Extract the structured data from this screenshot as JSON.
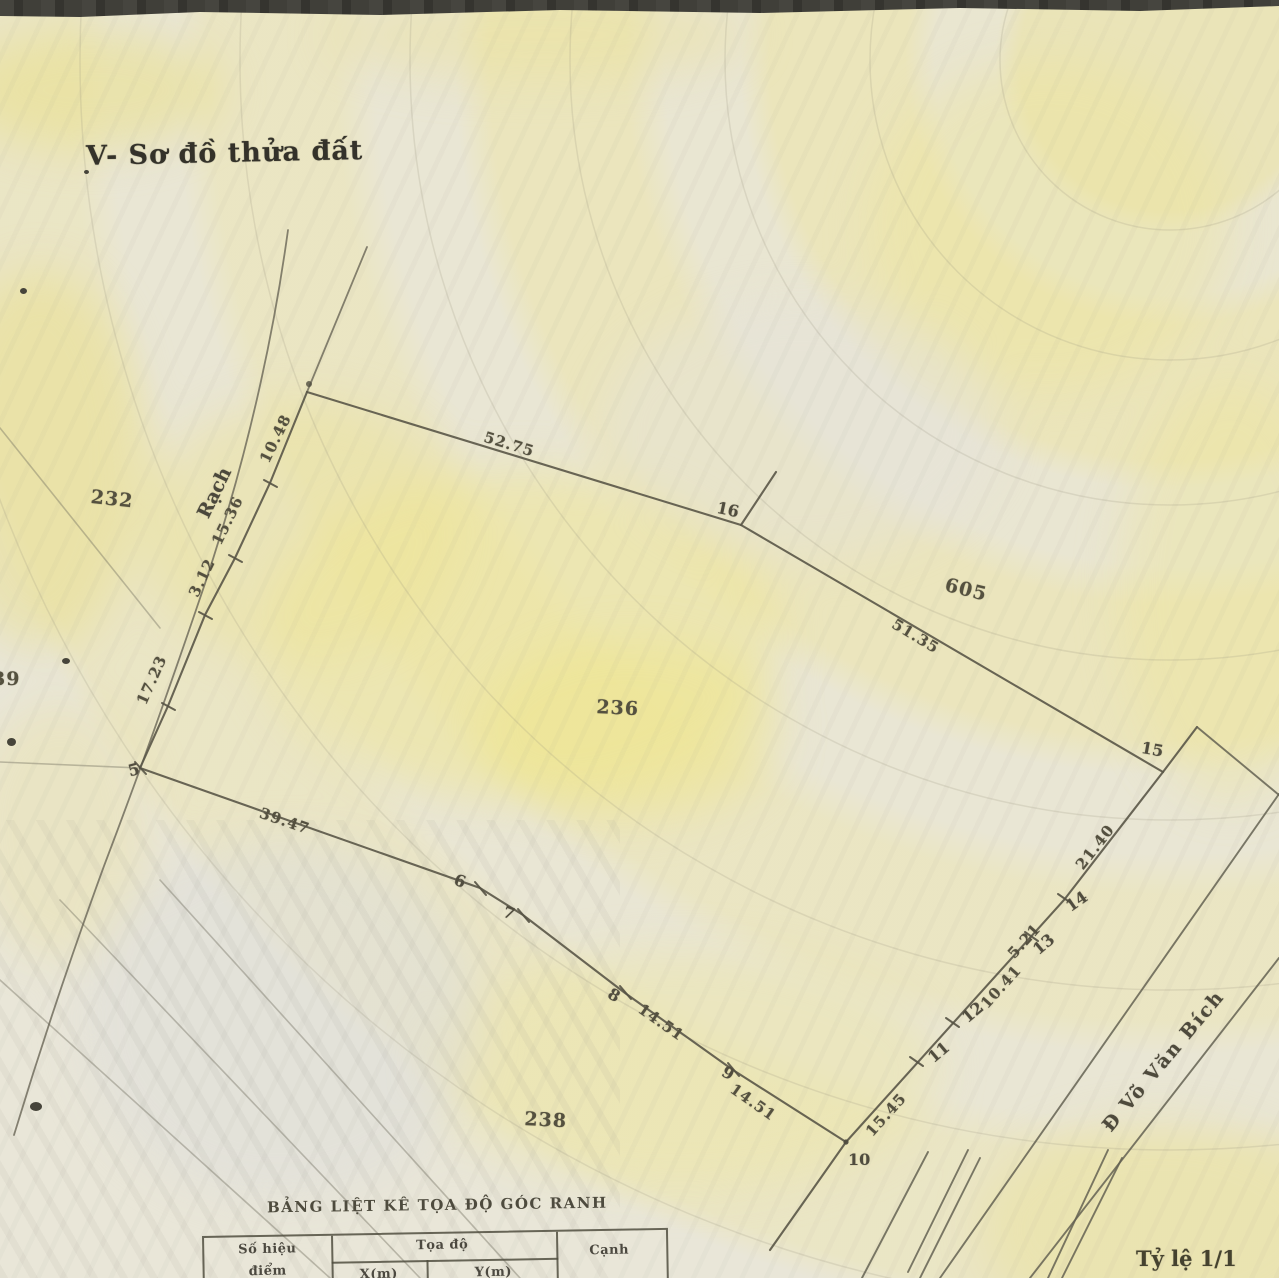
{
  "header": {
    "title": "V- Sơ đồ thửa đất"
  },
  "map": {
    "canal_label": "Rạch",
    "road_label": "Đ Võ Văn Bích",
    "scale_label": "Tỷ lệ 1/1",
    "parcels": {
      "p232": "232",
      "p236": "236",
      "p238": "238",
      "p605": "605",
      "p39": "39"
    },
    "vertices": {
      "v5": "5",
      "v6": "6",
      "v7": "7",
      "v8": "8",
      "v9": "9",
      "v10": "10",
      "v11": "11",
      "v12": "12",
      "v13": "13",
      "v14": "14",
      "v15": "15",
      "v16": "16"
    },
    "measurements": {
      "m10_48": "10.48",
      "m15_36": "15.36",
      "m3_12": "3.12",
      "m17_23": "17.23",
      "m52_75": "52.75",
      "m51_35": "51.35",
      "m39_47": "39.47",
      "m14_51_a": "14.51",
      "m14_51_b": "14.51",
      "m15_45": "15.45",
      "m10_41": "10.41",
      "m5_21": "5.21",
      "m21_40": "21.40"
    }
  },
  "table": {
    "title": "BẢNG LIỆT KÊ TỌA ĐỘ GÓC RANH",
    "col_id_line1": "Số hiệu",
    "col_id_line2": "điểm",
    "col_coords": "Tọa độ",
    "col_x": "X(m)",
    "col_y": "Y(m)",
    "col_edge": "Cạnh"
  }
}
